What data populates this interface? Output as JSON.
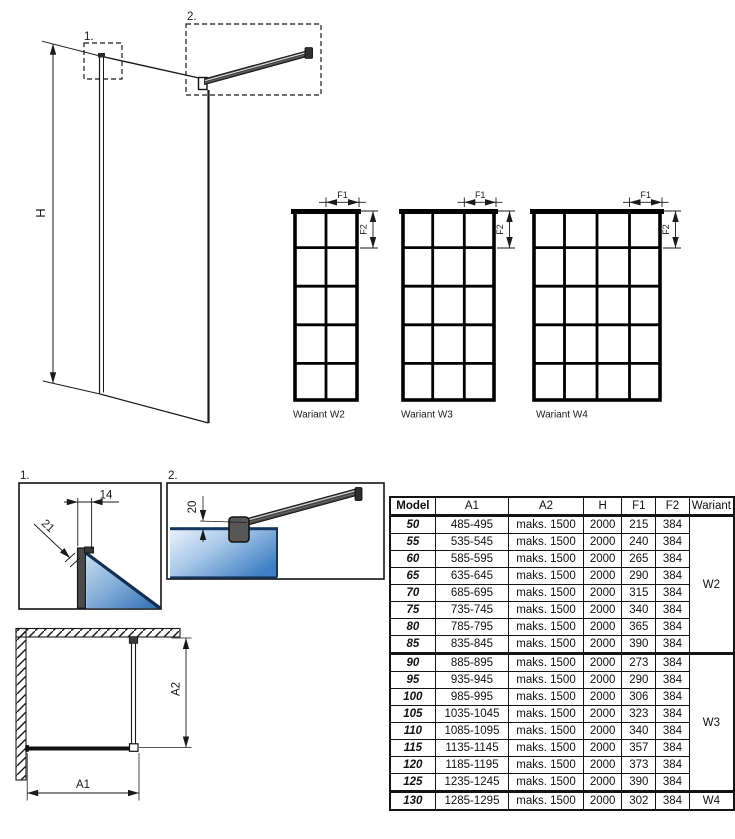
{
  "colors": {
    "line": "#1a1a1a",
    "glass_light": "#eaf2fa",
    "glass_dark": "#2f6cb3",
    "profile_gray": "#4d4d4d"
  },
  "iso_view": {
    "height_label": "H",
    "callout1": "1.",
    "callout2": "2."
  },
  "variants": [
    {
      "label": "Wariant W2",
      "columns": 2,
      "rows": 5,
      "f1": "F1",
      "f2": "F2"
    },
    {
      "label": "Wariant W3",
      "columns": 3,
      "rows": 5,
      "f1": "F1",
      "f2": "F2"
    },
    {
      "label": "Wariant W4",
      "columns": 4,
      "rows": 5,
      "f1": "F1",
      "f2": "F2"
    }
  ],
  "detail1": {
    "label": "1.",
    "dim_width": "14",
    "dim_edge": "21"
  },
  "detail2": {
    "label": "2.",
    "dim_offset": "20"
  },
  "plan_view": {
    "dim_a1": "A1",
    "dim_a2": "A2"
  },
  "table": {
    "headers": [
      "Model",
      "A1",
      "A2",
      "H",
      "F1",
      "F2",
      "Wariant"
    ],
    "rows": [
      {
        "model": "50",
        "a1": "485-495",
        "a2": "maks. 1500",
        "h": "2000",
        "f1": "215",
        "f2": "384",
        "wariant": "W2",
        "wariant_span": 8
      },
      {
        "model": "55",
        "a1": "535-545",
        "a2": "maks. 1500",
        "h": "2000",
        "f1": "240",
        "f2": "384"
      },
      {
        "model": "60",
        "a1": "585-595",
        "a2": "maks. 1500",
        "h": "2000",
        "f1": "265",
        "f2": "384"
      },
      {
        "model": "65",
        "a1": "635-645",
        "a2": "maks. 1500",
        "h": "2000",
        "f1": "290",
        "f2": "384"
      },
      {
        "model": "70",
        "a1": "685-695",
        "a2": "maks. 1500",
        "h": "2000",
        "f1": "315",
        "f2": "384"
      },
      {
        "model": "75",
        "a1": "735-745",
        "a2": "maks. 1500",
        "h": "2000",
        "f1": "340",
        "f2": "384"
      },
      {
        "model": "80",
        "a1": "785-795",
        "a2": "maks. 1500",
        "h": "2000",
        "f1": "365",
        "f2": "384"
      },
      {
        "model": "85",
        "a1": "835-845",
        "a2": "maks. 1500",
        "h": "2000",
        "f1": "390",
        "f2": "384"
      },
      {
        "model": "90",
        "a1": "885-895",
        "a2": "maks. 1500",
        "h": "2000",
        "f1": "273",
        "f2": "384",
        "wariant": "W3",
        "wariant_span": 8,
        "group_start": true
      },
      {
        "model": "95",
        "a1": "935-945",
        "a2": "maks. 1500",
        "h": "2000",
        "f1": "290",
        "f2": "384"
      },
      {
        "model": "100",
        "a1": "985-995",
        "a2": "maks. 1500",
        "h": "2000",
        "f1": "306",
        "f2": "384"
      },
      {
        "model": "105",
        "a1": "1035-1045",
        "a2": "maks. 1500",
        "h": "2000",
        "f1": "323",
        "f2": "384"
      },
      {
        "model": "110",
        "a1": "1085-1095",
        "a2": "maks. 1500",
        "h": "2000",
        "f1": "340",
        "f2": "384"
      },
      {
        "model": "115",
        "a1": "1135-1145",
        "a2": "maks. 1500",
        "h": "2000",
        "f1": "357",
        "f2": "384"
      },
      {
        "model": "120",
        "a1": "1185-1195",
        "a2": "maks. 1500",
        "h": "2000",
        "f1": "373",
        "f2": "384"
      },
      {
        "model": "125",
        "a1": "1235-1245",
        "a2": "maks. 1500",
        "h": "2000",
        "f1": "390",
        "f2": "384"
      },
      {
        "model": "130",
        "a1": "1285-1295",
        "a2": "maks. 1500",
        "h": "2000",
        "f1": "302",
        "f2": "384",
        "wariant": "W4",
        "wariant_span": 1,
        "group_start": true
      }
    ]
  }
}
